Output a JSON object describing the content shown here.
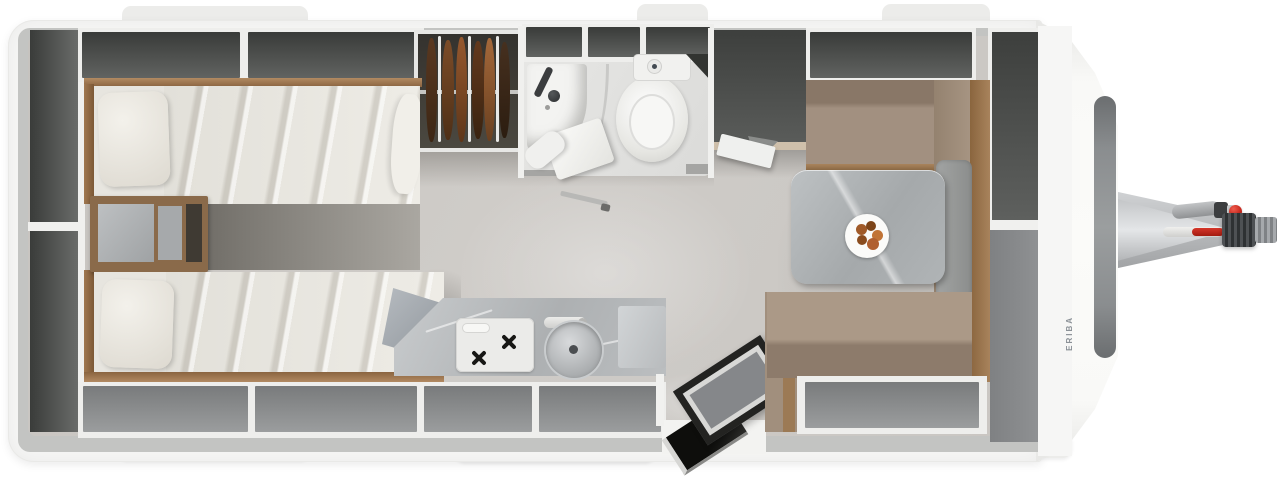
{
  "title": "Caravan interior floor plan, top view",
  "brand": {
    "label": "ERIBA"
  },
  "palette": {
    "accent_red": "#c6281e",
    "body_white": "#f6f6f5",
    "wall_gray": "#c3c4c2",
    "floor_gray": "#c8c5c1",
    "cabinet_dark": "#4a4c4a",
    "cabinet_medium": "#8d8f90",
    "wood": "#9c7a55",
    "upholstery": "#a29080",
    "marble": "#b0b4b6",
    "bedding": "#e7e5df",
    "bathroom_white": "#f3f3f1",
    "window_gray": "#8a8d8f"
  },
  "legend": {
    "rear_left": [
      "tall rear storage cabinets",
      "overhead lockers",
      "twin single beds with pillows and duvets",
      "bedside chest with marble top",
      "gray folded blanket"
    ],
    "middle_top": [
      "wardrobe with hanging clothes",
      "overhead lockers",
      "bathroom with shower, glass partition, toilet with cistern",
      "open bathroom door",
      "tall cabinet with open flap"
    ],
    "middle_bottom": [
      "kitchen counter with two-burner stove and round sink",
      "faucet",
      "under-window lockers",
      "entrance door open with step"
    ],
    "front_right": [
      "L-shaped dinette bench seats",
      "marble dining table with plate of food",
      "front sideboard",
      "front window",
      "brand lettering",
      "A-frame drawbar with jockey wheel, breakaway handle and hitch coupling with red knob"
    ]
  }
}
